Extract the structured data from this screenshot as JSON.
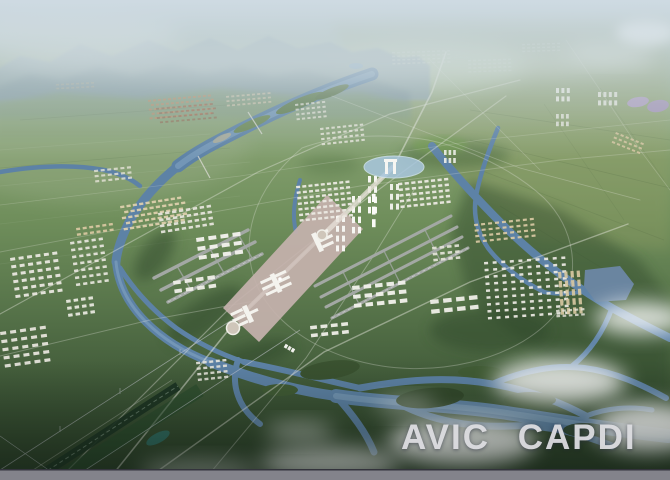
{
  "watermark": {
    "text": "AVIC CAPDI"
  },
  "palette": {
    "sky_top": "#bccdd4",
    "mountain_far": "#93a7ae",
    "mountain_near": "#7b939b",
    "foothill": "#87a077",
    "olive": "#9aa066",
    "river": "#5d82a6",
    "river_light": "#8db0ca",
    "ring_lake": "#a9c7df",
    "lake_purple": "#b2a0c9",
    "forest": "#2e472b",
    "apron": "#c6b2ae",
    "runway": "#a3a8a4",
    "road": "#e9e9e1",
    "building_white": "#eceae3",
    "building_tan": "#dcc9a3",
    "cloud": "#ffffff",
    "gate_white": "#f6f6f2",
    "watermark": "#dcdce0",
    "bottom_bar": "#83838b",
    "rail_dark": "#1b3322",
    "pond_teal": "#2f6f66"
  },
  "building_clusters": [
    {
      "name": "left-grid-a",
      "x": 10,
      "y": 258,
      "cols": 6,
      "rows": 6,
      "cw": 5,
      "ch": 3,
      "gx": 3.5,
      "gy": 4.5,
      "fill": "#e9e7df",
      "op": 0.95,
      "rot": -8
    },
    {
      "name": "left-grid-b",
      "x": 0,
      "y": 332,
      "cols": 5,
      "rows": 5,
      "cw": 6,
      "ch": 3.2,
      "gx": 4,
      "gy": 5,
      "fill": "#e6e4db",
      "op": 0.95,
      "rot": -8
    },
    {
      "name": "left-grid-c",
      "x": 70,
      "y": 242,
      "cols": 5,
      "rows": 7,
      "cw": 4.2,
      "ch": 2.6,
      "gx": 3,
      "gy": 4.4,
      "fill": "#e8e6de",
      "op": 0.92,
      "rot": -8
    },
    {
      "name": "left-tan",
      "x": 76,
      "y": 228,
      "cols": 6,
      "rows": 2,
      "cw": 4,
      "ch": 2.4,
      "gx": 2.6,
      "gy": 3.2,
      "fill": "#dcc9a3",
      "op": 0.9,
      "rot": -8
    },
    {
      "name": "town-tan",
      "x": 120,
      "y": 206,
      "cols": 10,
      "rows": 5,
      "cw": 4.2,
      "ch": 2.4,
      "gx": 2.2,
      "gy": 3.2,
      "fill": "#dfd0ae",
      "op": 0.92,
      "rot": -9,
      "stagger": true
    },
    {
      "name": "town-white",
      "x": 158,
      "y": 213,
      "cols": 8,
      "rows": 4,
      "cw": 4.4,
      "ch": 2.6,
      "gx": 2.6,
      "gy": 3.4,
      "fill": "#e8e6de",
      "op": 0.92,
      "rot": -9
    },
    {
      "name": "north-town",
      "x": 94,
      "y": 170,
      "cols": 6,
      "rows": 3,
      "cw": 4,
      "ch": 2.2,
      "gx": 2.6,
      "gy": 3,
      "fill": "#e6e3d8",
      "op": 0.8,
      "rot": -6
    },
    {
      "name": "south-grid",
      "x": 196,
      "y": 362,
      "cols": 5,
      "rows": 4,
      "cw": 4,
      "ch": 2.4,
      "gx": 2.6,
      "gy": 3.2,
      "fill": "#e8e6de",
      "op": 0.9,
      "rot": -6
    },
    {
      "name": "left-grid-d",
      "x": 66,
      "y": 300,
      "cols": 4,
      "rows": 3,
      "cw": 4.5,
      "ch": 3,
      "gx": 3,
      "gy": 4,
      "fill": "#eeede6",
      "op": 0.9,
      "rot": -8
    },
    {
      "name": "village-roofs-a",
      "x": 148,
      "y": 100,
      "cols": 13,
      "rows": 5,
      "cw": 3,
      "ch": 1.9,
      "gx": 2,
      "gy": 2.5,
      "fill": "#b78c6a",
      "op": 0.85,
      "rot": -5,
      "stagger": true
    },
    {
      "name": "village-roofs-b",
      "x": 156,
      "y": 108,
      "cols": 11,
      "rows": 4,
      "cw": 3,
      "ch": 1.8,
      "gx": 2.4,
      "gy": 2.8,
      "fill": "#915d48",
      "op": 0.6,
      "rot": -5,
      "stagger": true
    },
    {
      "name": "village-roofs-c",
      "x": 226,
      "y": 96,
      "cols": 9,
      "rows": 3,
      "cw": 3,
      "ch": 1.8,
      "gx": 2.2,
      "gy": 2.6,
      "fill": "#cfc3ab",
      "op": 0.75,
      "rot": -5
    },
    {
      "name": "far-village",
      "x": 56,
      "y": 84,
      "cols": 8,
      "rows": 2,
      "cw": 3,
      "ch": 1.6,
      "gx": 2,
      "gy": 2.2,
      "fill": "#b3ab92",
      "op": 0.5,
      "rot": -3
    },
    {
      "name": "city-left",
      "x": 296,
      "y": 186,
      "cols": 9,
      "rows": 7,
      "cw": 4,
      "ch": 2.4,
      "gx": 2.2,
      "gy": 3.2,
      "fill": "#ebe9e2",
      "op": 0.95,
      "rot": -6
    },
    {
      "name": "city-right",
      "x": 398,
      "y": 183,
      "cols": 8,
      "rows": 5,
      "cw": 4.2,
      "ch": 2.5,
      "gx": 2.4,
      "gy": 3.2,
      "fill": "#ebe9e2",
      "op": 0.95,
      "rot": -6
    },
    {
      "name": "ne-blocks-a",
      "x": 295,
      "y": 104,
      "cols": 6,
      "rows": 4,
      "cw": 3.2,
      "ch": 2,
      "gx": 2.2,
      "gy": 2.8,
      "fill": "#e4e1d6",
      "op": 0.8,
      "rot": -6
    },
    {
      "name": "ne-blocks-b",
      "x": 320,
      "y": 128,
      "cols": 8,
      "rows": 4,
      "cw": 3.4,
      "ch": 2.1,
      "gx": 2.3,
      "gy": 3,
      "fill": "#e8e5da",
      "op": 0.85,
      "rot": -6
    },
    {
      "name": "distant-city-a",
      "x": 392,
      "y": 52,
      "cols": 12,
      "rows": 4,
      "cw": 3,
      "ch": 1.5,
      "gx": 2,
      "gy": 2.2,
      "fill": "#cdd6c9",
      "op": 0.5,
      "rot": -2
    },
    {
      "name": "distant-city-b",
      "x": 468,
      "y": 60,
      "cols": 9,
      "rows": 4,
      "cw": 3,
      "ch": 1.5,
      "gx": 2,
      "gy": 2.2,
      "fill": "#c9d2c5",
      "op": 0.45,
      "rot": -2
    },
    {
      "name": "distant-city-c",
      "x": 522,
      "y": 44,
      "cols": 8,
      "rows": 3,
      "cw": 3,
      "ch": 1.4,
      "gx": 2,
      "gy": 2,
      "fill": "#d0d8cb",
      "op": 0.4,
      "rot": -2
    },
    {
      "name": "tr-towers-a",
      "x": 556,
      "y": 88,
      "cols": 3,
      "rows": 2,
      "cw": 3,
      "ch": 5,
      "gx": 2.4,
      "gy": 3.4,
      "fill": "#f0efe9",
      "op": 0.9,
      "rot": 0
    },
    {
      "name": "tr-towers-b",
      "x": 598,
      "y": 92,
      "cols": 4,
      "rows": 2,
      "cw": 3,
      "ch": 5,
      "gx": 2.4,
      "gy": 3.4,
      "fill": "#eeede7",
      "op": 0.85,
      "rot": 0
    },
    {
      "name": "tr-towers-c",
      "x": 556,
      "y": 114,
      "cols": 3,
      "rows": 2,
      "cw": 2.8,
      "ch": 4.6,
      "gx": 2.2,
      "gy": 3,
      "fill": "#ecebe5",
      "op": 0.8,
      "rot": 0
    },
    {
      "name": "tr-diag-rows",
      "x": 616,
      "y": 132,
      "cols": 6,
      "rows": 3,
      "cw": 3.2,
      "ch": 2,
      "gx": 2.2,
      "gy": 2.8,
      "fill": "#d8c7a2",
      "op": 0.85,
      "rot": 22
    },
    {
      "name": "right-tan-rows",
      "x": 474,
      "y": 224,
      "cols": 9,
      "rows": 4,
      "cw": 4,
      "ch": 2.2,
      "gx": 3,
      "gy": 3.4,
      "fill": "#ddcba6",
      "op": 0.9,
      "rot": -6
    },
    {
      "name": "right-small",
      "x": 432,
      "y": 247,
      "cols": 4,
      "rows": 3,
      "cw": 4.5,
      "ch": 2.6,
      "gx": 3,
      "gy": 3.4,
      "fill": "#e7e5dc",
      "op": 0.9,
      "rot": -6
    },
    {
      "name": "right-big-grid",
      "x": 484,
      "y": 262,
      "cols": 10,
      "rows": 9,
      "cw": 4,
      "ch": 2.5,
      "gx": 4.6,
      "gy": 4.4,
      "fill": "#e9e7e0",
      "op": 0.95,
      "rot": -4
    },
    {
      "name": "right-tan-bars",
      "x": 558,
      "y": 272,
      "cols": 4,
      "rows": 5,
      "cw": 3.2,
      "ch": 6.5,
      "gx": 3,
      "gy": 2.6,
      "fill": "#d9c9a2",
      "op": 0.9,
      "rot": -4
    },
    {
      "name": "right-rows-low",
      "x": 556,
      "y": 310,
      "cols": 5,
      "rows": 2,
      "cw": 3.6,
      "ch": 2.2,
      "gx": 2.6,
      "gy": 3,
      "fill": "#e7e5dc",
      "op": 0.8,
      "rot": -4
    },
    {
      "name": "ne-towers",
      "x": 444,
      "y": 150,
      "cols": 3,
      "rows": 2,
      "cw": 2.6,
      "ch": 5,
      "gx": 2,
      "gy": 3,
      "fill": "#f0f0ea",
      "op": 0.9,
      "rot": 0
    },
    {
      "name": "hangars-west",
      "x": 196,
      "y": 238,
      "cols": 4,
      "rows": 3,
      "cw": 8,
      "ch": 4,
      "gx": 4.2,
      "gy": 5,
      "fill": "#f2f1eb",
      "op": 0.97,
      "rot": -8
    },
    {
      "name": "hangars-west-low",
      "x": 173,
      "y": 281,
      "cols": 4,
      "rows": 2,
      "cw": 7.5,
      "ch": 3.8,
      "gx": 4,
      "gy": 4.8,
      "fill": "#f0efe9",
      "op": 0.95,
      "rot": -8
    },
    {
      "name": "hangars-east",
      "x": 352,
      "y": 286,
      "cols": 5,
      "rows": 3,
      "cw": 7.5,
      "ch": 4,
      "gx": 4,
      "gy": 5,
      "fill": "#f0efe9",
      "op": 0.97,
      "rot": -6
    },
    {
      "name": "hangars-far-east",
      "x": 430,
      "y": 300,
      "cols": 4,
      "rows": 2,
      "cw": 8.5,
      "ch": 4.2,
      "gx": 4.5,
      "gy": 5.5,
      "fill": "#efeee8",
      "op": 0.95,
      "rot": -6
    },
    {
      "name": "hangars-south",
      "x": 310,
      "y": 326,
      "cols": 4,
      "rows": 2,
      "cw": 6.8,
      "ch": 3.5,
      "gx": 3.6,
      "gy": 4.4,
      "fill": "#efeee8",
      "op": 0.95,
      "rot": -6
    },
    {
      "name": "axis-highrise-a",
      "x": 368,
      "y": 176,
      "cols": 2,
      "rows": 4,
      "cw": 3,
      "ch": 6.5,
      "gx": 3,
      "gy": 3.8,
      "fill": "#f7f7f3",
      "op": 1,
      "rot": 0
    },
    {
      "name": "axis-highrise-b",
      "x": 352,
      "y": 196,
      "cols": 2,
      "rows": 4,
      "cw": 3,
      "ch": 6.5,
      "gx": 3,
      "gy": 3.8,
      "fill": "#f7f7f3",
      "op": 1,
      "rot": 0
    },
    {
      "name": "axis-highrise-c",
      "x": 336,
      "y": 216,
      "cols": 2,
      "rows": 4,
      "cw": 3,
      "ch": 6,
      "gx": 3,
      "gy": 3.8,
      "fill": "#f5f5f1",
      "op": 1,
      "rot": 0
    },
    {
      "name": "axis-highrise-d",
      "x": 390,
      "y": 184,
      "cols": 2,
      "rows": 3,
      "cw": 3,
      "ch": 6,
      "gx": 3,
      "gy": 3.8,
      "fill": "#f2f2ee",
      "op": 0.95,
      "rot": 0
    },
    {
      "name": "axis-towers",
      "x": 372,
      "y": 194,
      "cols": 1,
      "rows": 3,
      "cw": 3.6,
      "ch": 8,
      "gx": 0,
      "gy": 4.6,
      "fill": "#fbfbf8",
      "op": 1,
      "rot": 0
    }
  ]
}
